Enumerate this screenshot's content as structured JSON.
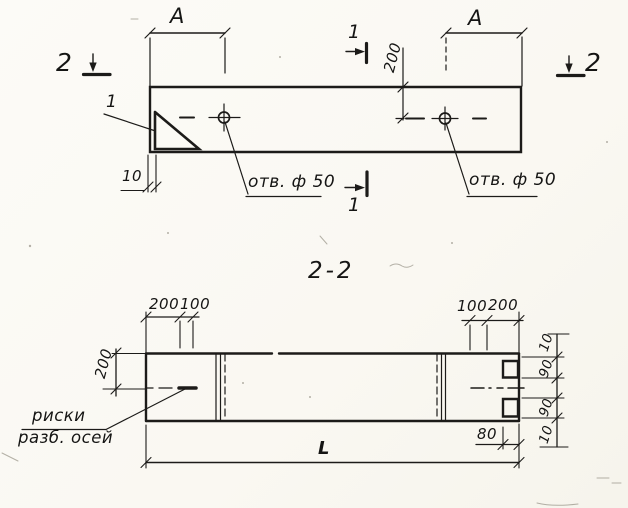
{
  "drawing": {
    "ink_color": "#1c1b19",
    "paper_color": "#fbfaf5",
    "top_view": {
      "dim_a": "A",
      "dim_offset": "200",
      "dim_edge": "10",
      "hole_label": "отв. ф 50",
      "section_mark_1": "1",
      "section_mark_2": "2",
      "detail_mark": "1"
    },
    "section_view": {
      "title": "2-2",
      "dims": {
        "left_a": "200",
        "left_b": "100",
        "right_a": "100",
        "right_b": "200",
        "height": "200",
        "edge_top": "10",
        "notch_top": "90",
        "notch_bottom": "90",
        "edge_bottom": "10",
        "notch_depth": "80",
        "length": "L"
      },
      "axis_label_line1": "риски",
      "axis_label_line2": "разб. осей"
    }
  }
}
